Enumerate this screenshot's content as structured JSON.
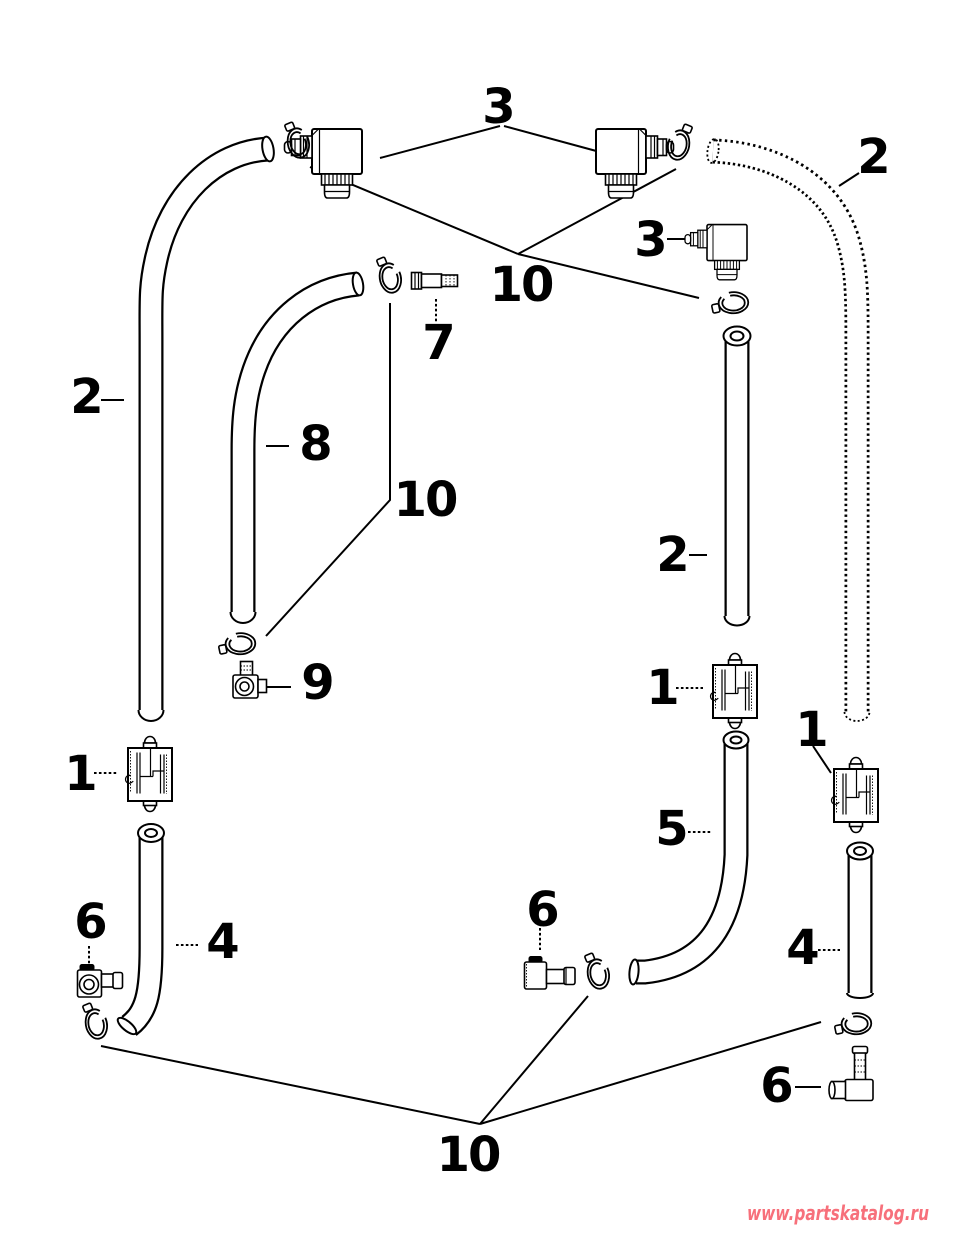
{
  "figure": {
    "background_color": "#ffffff",
    "line_color": "#000000",
    "callouts": {
      "three_top": "3",
      "two_top_right": "2",
      "three_right": "3",
      "ten_top": "10",
      "seven": "7",
      "two_left": "2",
      "eight": "8",
      "ten_middle": "10",
      "two_middle": "2",
      "nine": "9",
      "one_middle": "1",
      "one_left": "1",
      "one_right": "1",
      "five": "5",
      "six_left": "6",
      "four_left": "4",
      "six_middle": "6",
      "four_right": "4",
      "six_right": "6",
      "ten_bottom": "10"
    },
    "watermark": {
      "text": "www.partskatalog.ru",
      "color": "#f7707b"
    }
  }
}
